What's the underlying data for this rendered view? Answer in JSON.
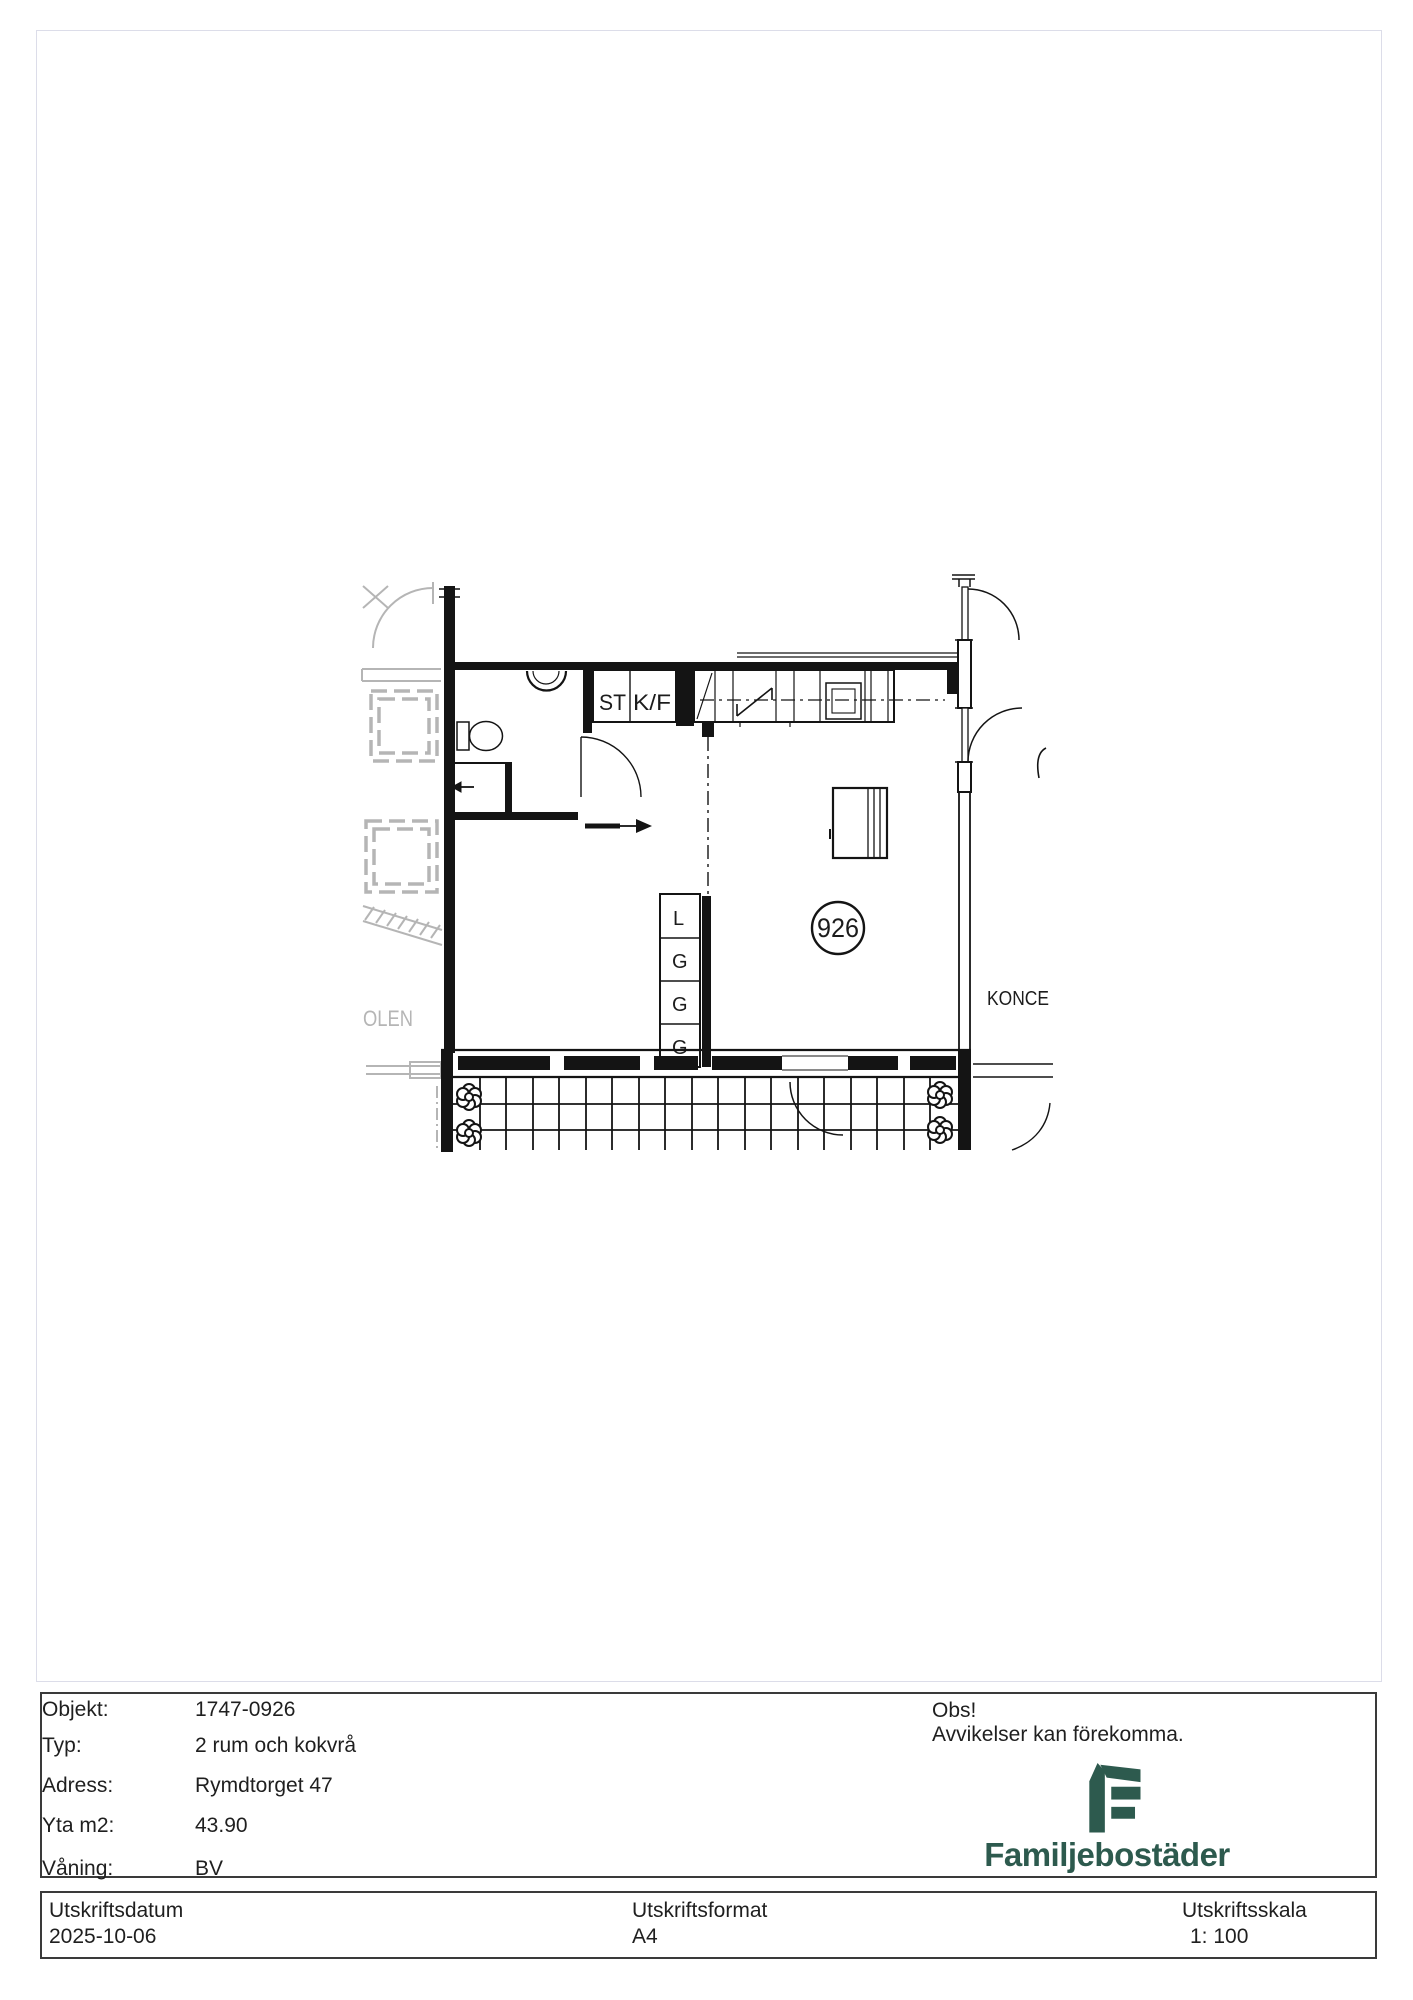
{
  "floorplan": {
    "room_number": "926",
    "labels": {
      "st": "ST",
      "kf": "K/F",
      "koncept": "KONCE",
      "context": "OLEN"
    },
    "closets": [
      "L",
      "G",
      "G",
      "G"
    ]
  },
  "info": {
    "rows": [
      {
        "label": "Objekt:",
        "value": "1747-0926"
      },
      {
        "label": "Typ:",
        "value": "2 rum och kokvrå"
      },
      {
        "label": "Adress:",
        "value": "Rymdtorget 47"
      },
      {
        "label": "Yta m2:",
        "value": "43.90"
      },
      {
        "label": "Våning:",
        "value": "BV"
      }
    ],
    "notice_title": "Obs!",
    "notice_text": "Avvikelser kan förekomma.",
    "brand": "Familjebostäder",
    "brand_color": "#2d5a4e"
  },
  "printinfo": {
    "columns": [
      {
        "label": "Utskriftsdatum",
        "value": "2025-10-06"
      },
      {
        "label": "Utskriftsformat",
        "value": "A4"
      },
      {
        "label": "Utskriftsskala",
        "value": "1: 100"
      }
    ]
  }
}
